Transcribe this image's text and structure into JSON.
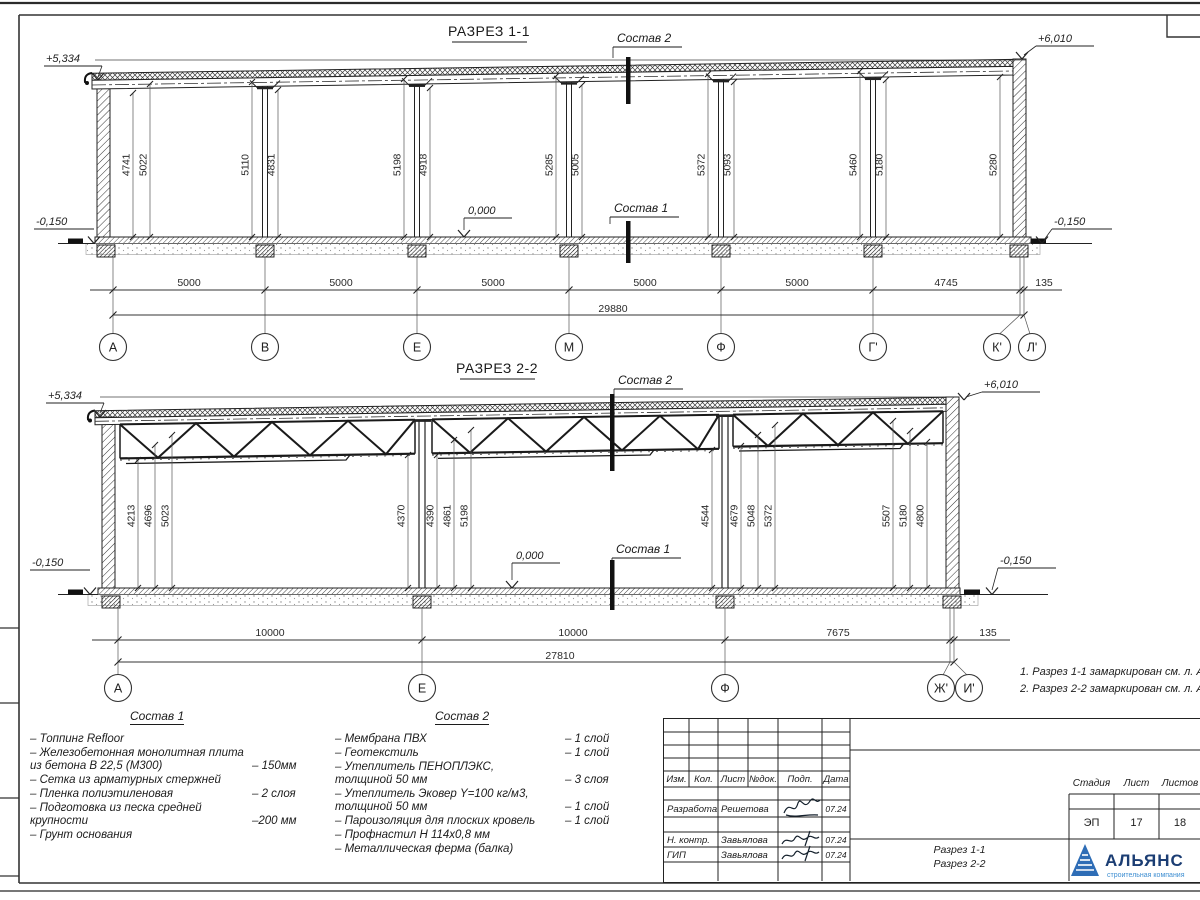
{
  "s1": {
    "title": "РАЗРЕЗ 1-1",
    "callout_top": "Состав 2",
    "callout_bottom": "Состав 1",
    "elev_tl": "+5,334",
    "elev_bl": "-0,150",
    "elev_tr": "+6,010",
    "elev_br": "-0,150",
    "elev_floor": "0,000",
    "heights": [
      "4741",
      "5022",
      "5110",
      "4831",
      "5198",
      "4918",
      "5285",
      "5005",
      "5372",
      "5093",
      "5460",
      "5180",
      "5280"
    ],
    "spans": [
      "5000",
      "5000",
      "5000",
      "5000",
      "5000",
      "4745",
      "135"
    ],
    "total": "29880",
    "axes": [
      "А",
      "В",
      "Е",
      "М",
      "Ф",
      "Г'",
      "К'",
      "Л'"
    ]
  },
  "s2": {
    "title": "РАЗРЕЗ 2-2",
    "callout_top": "Состав 2",
    "callout_bottom": "Состав 1",
    "elev_tl": "+5,334",
    "elev_bl": "-0,150",
    "elev_tr": "+6,010",
    "elev_br": "-0,150",
    "elev_floor": "0,000",
    "heights": [
      "4213",
      "4696",
      "5023",
      "4370",
      "4390",
      "4861",
      "5198",
      "4544",
      "4679",
      "5048",
      "5372",
      "5507",
      "5180",
      "4800"
    ],
    "spans": [
      "10000",
      "10000",
      "7675",
      "135"
    ],
    "total": "27810",
    "axes": [
      "А",
      "Е",
      "Ф",
      "Ж'",
      "И'"
    ]
  },
  "notes": [
    "1. Разрез 1-1 замаркирован см. л. АР-15",
    "2. Разрез 2-2 замаркирован см. л. АР-16"
  ],
  "comp1": {
    "title": "Состав 1",
    "items": [
      {
        "t": "– Топпинг Refloor",
        "v": ""
      },
      {
        "t": "– Железобетонная  монолитная плита\nиз бетона В 22,5 (М300)",
        "v": "– 150мм"
      },
      {
        "t": "– Сетка из арматурных стержней",
        "v": ""
      },
      {
        "t": "– Пленка полиэтиленовая",
        "v": "–  2 слоя"
      },
      {
        "t": "– Подготовка из песка средней\nкрупности",
        "v": "–200 мм"
      },
      {
        "t": "– Грунт основания",
        "v": ""
      }
    ]
  },
  "comp2": {
    "title": "Состав 2",
    "items": [
      {
        "t": "– Мембрана ПВХ",
        "v": "– 1 слой"
      },
      {
        "t": "– Геотекстиль",
        "v": "– 1 слой"
      },
      {
        "t": "– Утеплитель ПЕНОПЛЭКС,\nтолщиной 50 мм",
        "v": "– 3 слоя"
      },
      {
        "t": "– Утеплитель Эковер Y=100 кг/м3,\nтолщиной 50 мм",
        "v": "– 1 слой"
      },
      {
        "t": "– Пароизоляция для плоских кровель",
        "v": "– 1 слой"
      },
      {
        "t": "– Профнастил Н 114х0,8 мм",
        "v": ""
      },
      {
        "t": "– Металлическая ферма (балка)",
        "v": ""
      }
    ]
  },
  "tb": {
    "cols": [
      "Изм.",
      "Кол.",
      "Лист",
      "№док.",
      "Подп.",
      "Дата"
    ],
    "rows": [
      {
        "role": "Разработал",
        "name": "Решетова",
        "date": "07.24"
      },
      {
        "role": "Н. контр.",
        "name": "Завьялова",
        "date": "07.24"
      },
      {
        "role": "ГИП",
        "name": "Завьялова",
        "date": "07.24"
      }
    ],
    "stage_label": "Стадия",
    "sheet_label": "Лист",
    "sheets_label": "Листов",
    "stage": "ЭП",
    "sheet": "17",
    "sheets": "18",
    "title1": "Разрез 1-1",
    "title2": "Разрез 2-2",
    "logo": "АЛЬЯНС",
    "logo_sub": "строительная компания",
    "logo_color": "#1b3d73",
    "logo_sub_color": "#3f8fd2",
    "logo_tri_color": "#2e6db6"
  }
}
